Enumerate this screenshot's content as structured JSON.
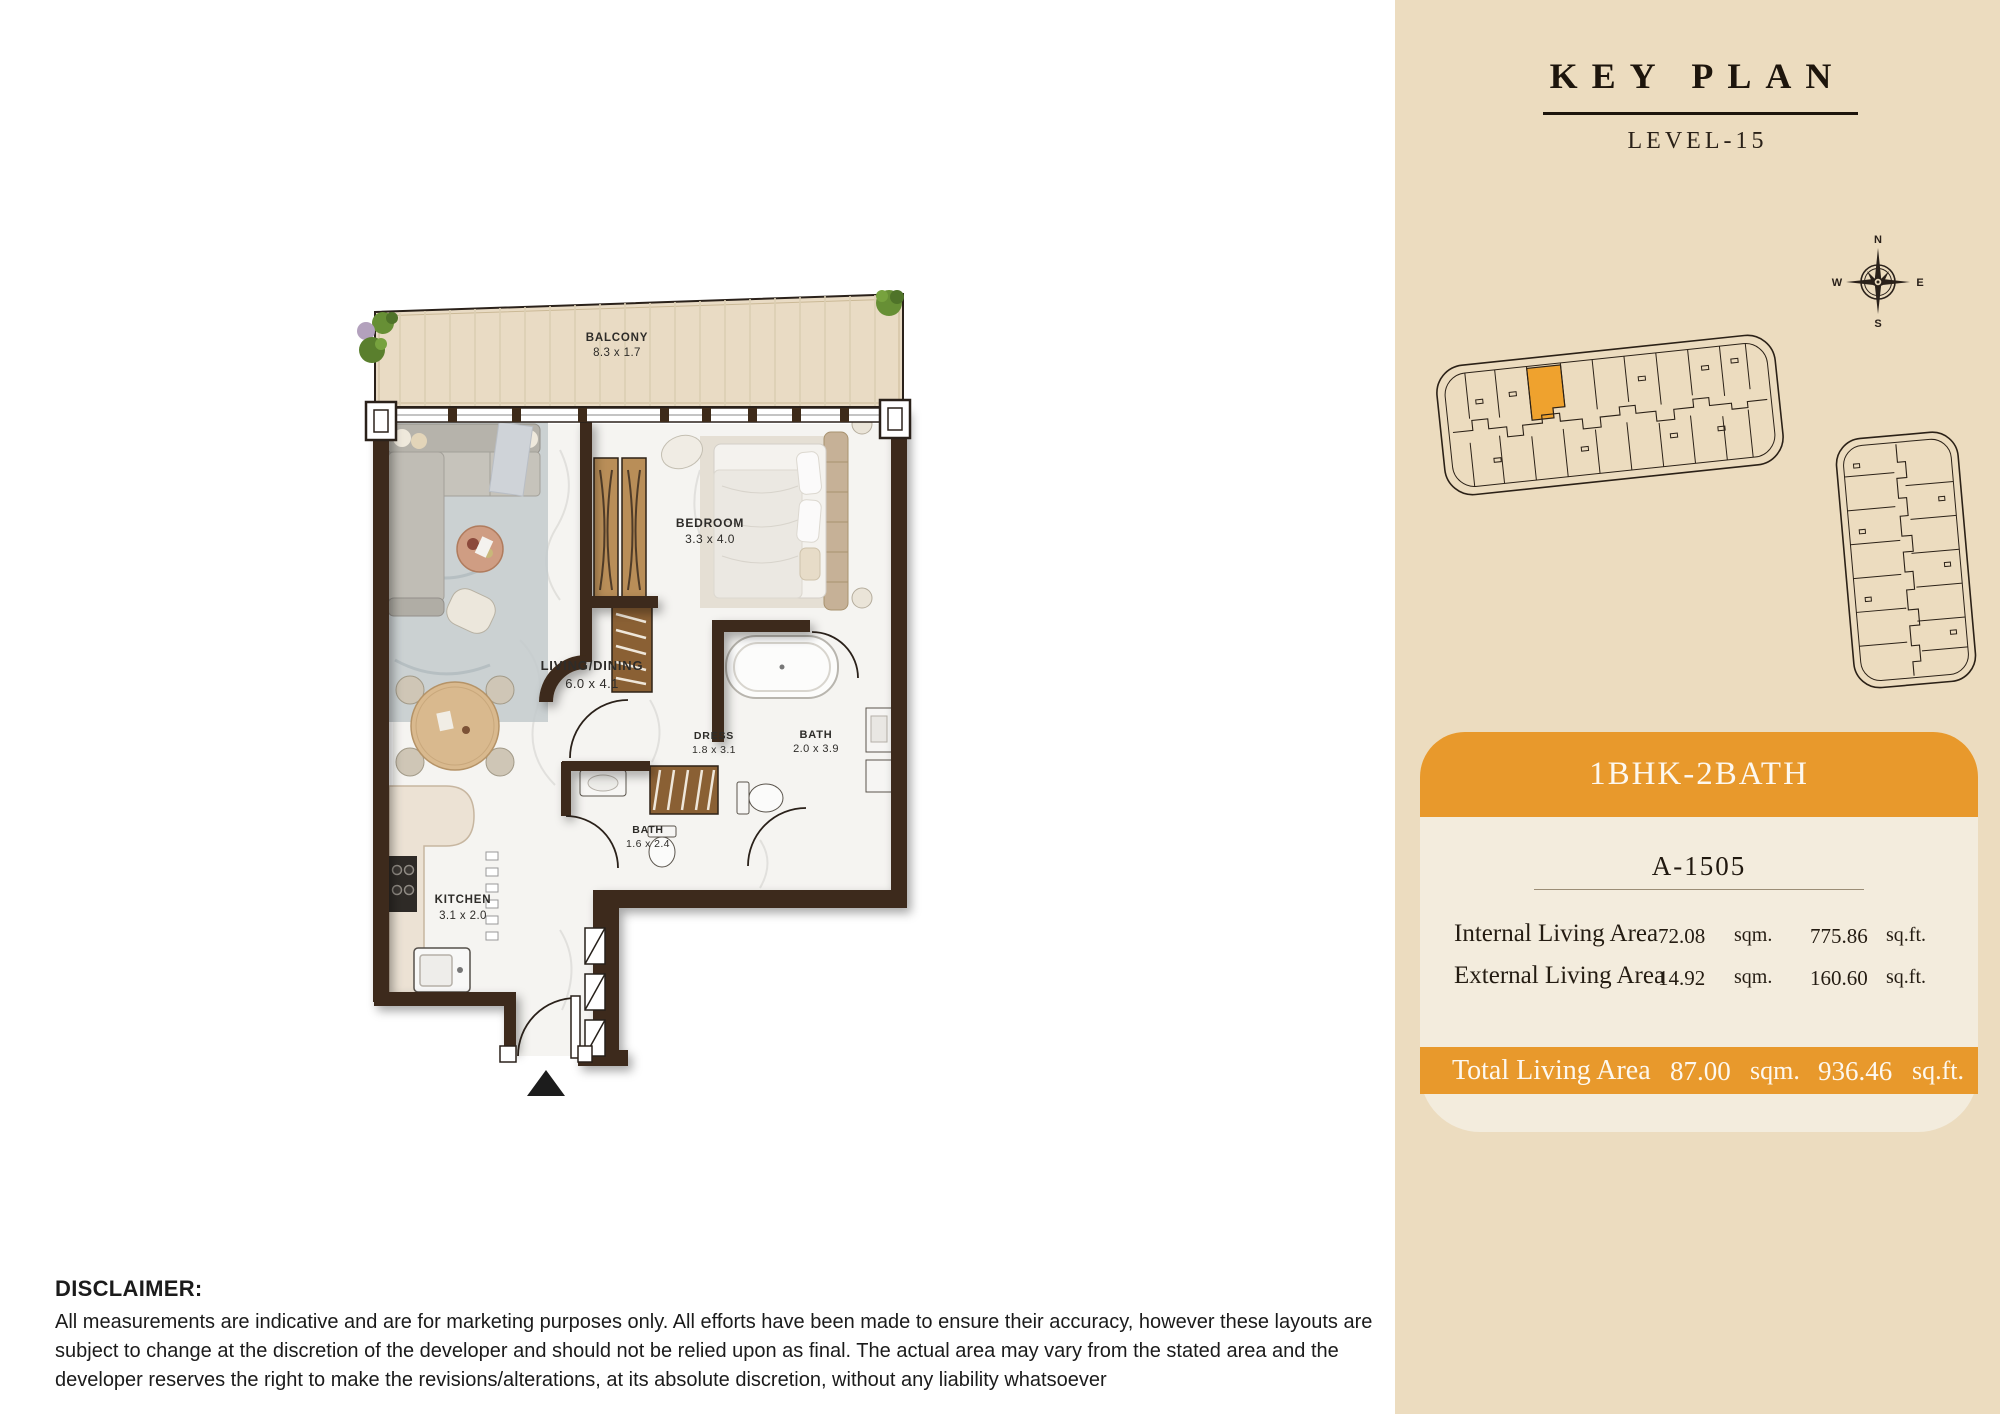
{
  "key_plan": {
    "title": "KEY PLAN",
    "level": "LEVEL-15",
    "compass": {
      "n": "N",
      "e": "E",
      "s": "S",
      "w": "W"
    }
  },
  "unit_card": {
    "type": "1BHK-2BATH",
    "unit_number": "A-1505",
    "rows": [
      {
        "label": "Internal Living Area",
        "sqm": "72.08",
        "sqm_unit": "sqm.",
        "sqft": "775.86",
        "sqft_unit": "sq.ft."
      },
      {
        "label": "External Living Area",
        "sqm": "14.92",
        "sqm_unit": "sqm.",
        "sqft": "160.60",
        "sqft_unit": "sq.ft."
      }
    ],
    "total": {
      "label": "Total Living Area",
      "sqm": "87.00",
      "sqm_unit": "sqm.",
      "sqft": "936.46",
      "sqft_unit": "sq.ft."
    }
  },
  "floor_plan": {
    "rooms": [
      {
        "name": "BALCONY",
        "dims": "8.3 x 1.7"
      },
      {
        "name": "LIVING/DINING",
        "dims": "6.0 x 4.1"
      },
      {
        "name": "BEDROOM",
        "dims": "3.3 x 4.0"
      },
      {
        "name": "DRESS",
        "dims": "1.8 x 3.1"
      },
      {
        "name": "BATH",
        "dims": "2.0 x 3.9"
      },
      {
        "name": "BATH",
        "dims": "1.6 x 2.4"
      },
      {
        "name": "KITCHEN",
        "dims": "3.1 x 2.0"
      }
    ]
  },
  "disclaimer": {
    "heading": "DISCLAIMER:",
    "body": "All measurements are indicative and are for marketing purposes only. All efforts have been made to ensure their accuracy, however these layouts are subject to change at the discretion of the developer and should not be relied upon as final. The actual area may vary from the stated area and the developer reserves the right to make the revisions/alterations, at its absolute discretion, without any liability whatsoever"
  },
  "colors": {
    "panel_bg": "#ecdcbf",
    "card_bg": "#f3ecdd",
    "accent_orange": "#e8992c",
    "highlight_unit": "#efa22e",
    "wall_brown": "#3e2b1a",
    "balcony_wood": "#e9dbc4"
  }
}
